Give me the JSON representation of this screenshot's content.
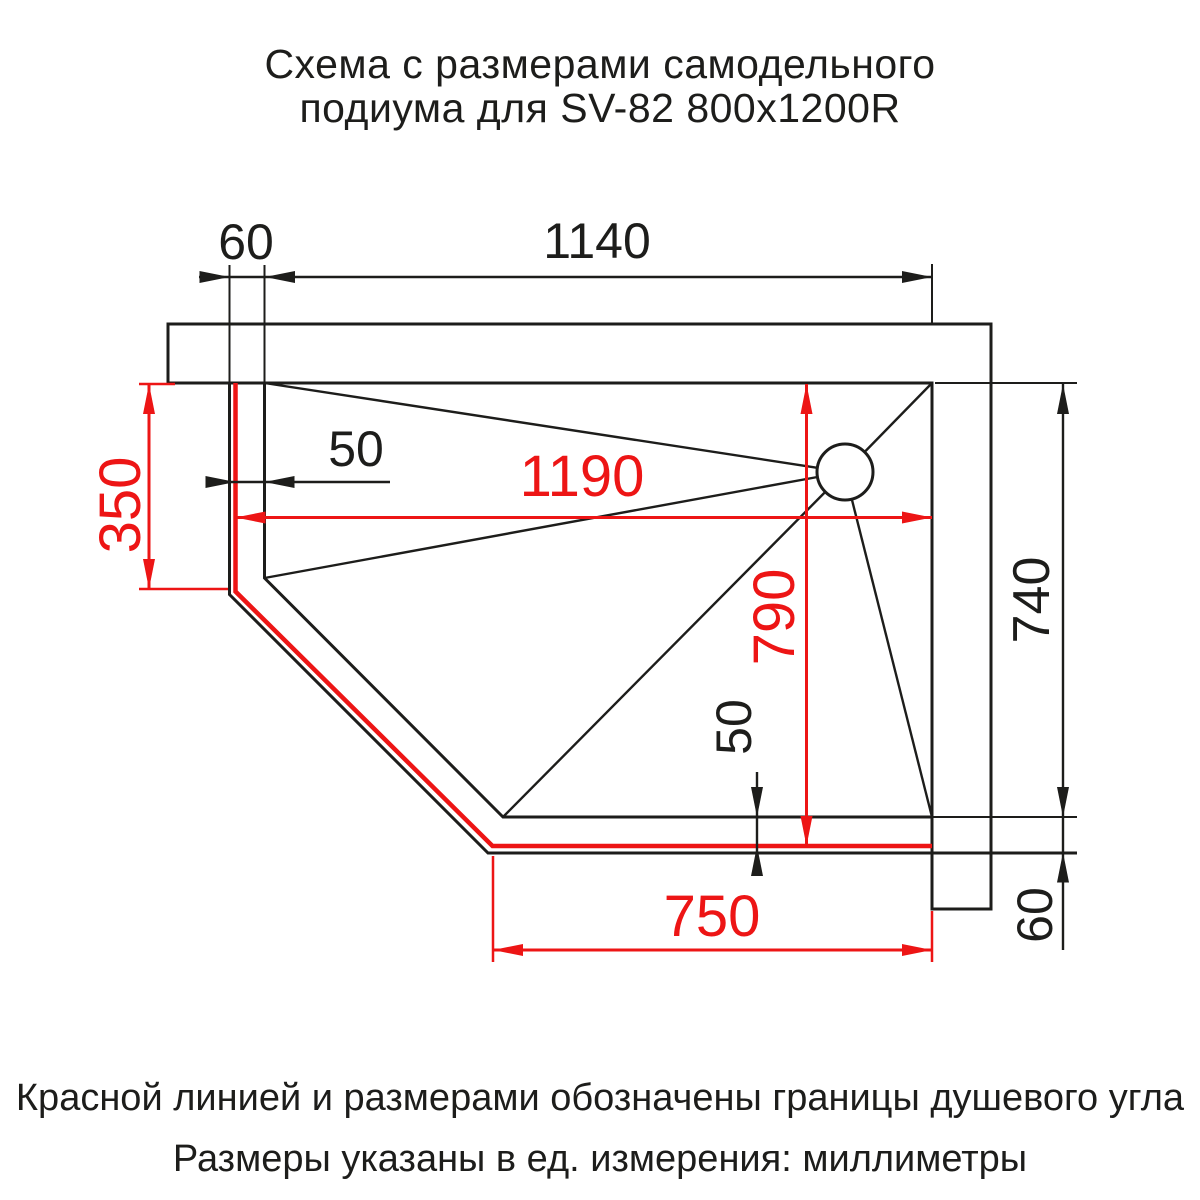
{
  "title": {
    "line1": "Схема с размерами самодельного",
    "line2": "подиума для SV-82 800x1200R"
  },
  "notes": {
    "line1": "Красной линией и размерами обозначены границы душевого угла",
    "line2": "Размеры указаны в ед. измерения: миллиметры"
  },
  "units": "миллиметры",
  "colors": {
    "boundary_red": "#ed1515",
    "drawing_black": "#1d1d1b"
  },
  "dimensions": {
    "wall_offset_top": "60",
    "podium_width_top": "1140",
    "left_red_height": "350",
    "rim_left": "50",
    "shower_width": "1190",
    "shower_depth": "790",
    "rim_bottom": "50",
    "shower_bottom_width": "750",
    "right_height": "740",
    "rim_bottom_right": "60"
  }
}
